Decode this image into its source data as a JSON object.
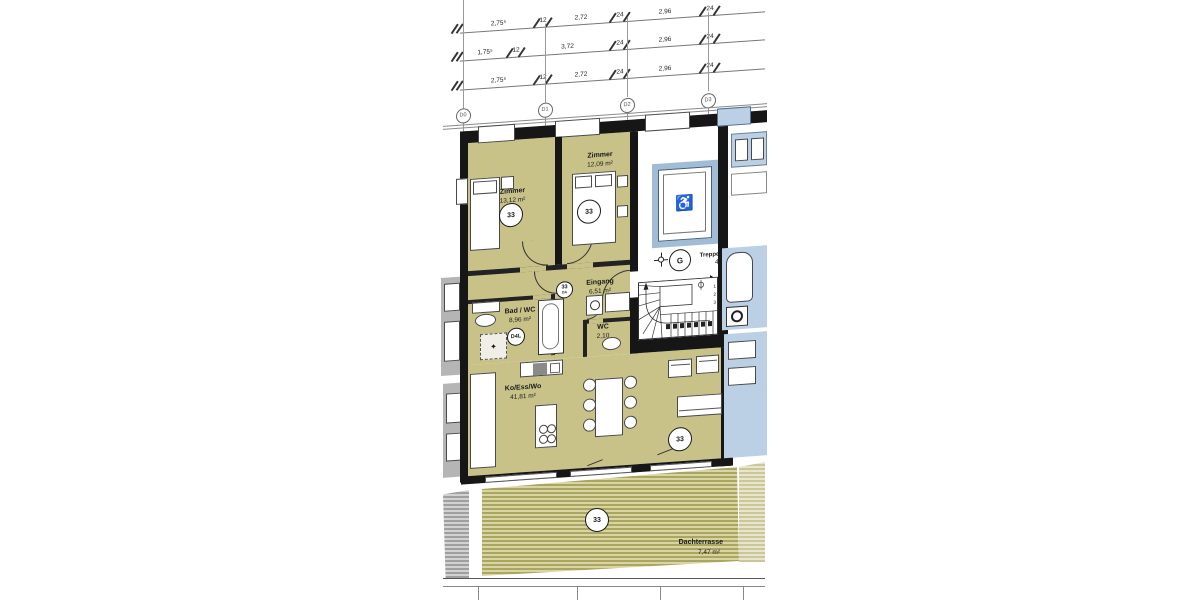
{
  "plan": {
    "rooms": [
      {
        "name": "Zimmer",
        "area": "13,12 m²"
      },
      {
        "name": "Zimmer",
        "area": "12,09 m²"
      },
      {
        "name": "Eingang",
        "area": "6,51 m²"
      },
      {
        "name": "Bad / WC",
        "area": "8,96 m²"
      },
      {
        "name": "WC",
        "area": "2,10"
      },
      {
        "name": "Ko/Ess/Wo",
        "area": "41,81 m²"
      },
      {
        "name": "Treppenhaus",
        "area": "4,95 m²"
      },
      {
        "name": "Dachterrasse",
        "area": "7,47 m²"
      }
    ],
    "markers": {
      "unit": "33",
      "unit_sub": "DA",
      "door": "D4L",
      "point": "G"
    },
    "grid": [
      "D0",
      "D1",
      "D2",
      "D3"
    ],
    "dims": {
      "rows": [
        {
          "segs": [
            "2,75⁵",
            "12",
            "2,72",
            "24",
            "2,96",
            "24"
          ]
        },
        {
          "segs": [
            "1,75⁵",
            "12",
            "3,72",
            "24",
            "2,96",
            "24"
          ]
        },
        {
          "segs": [
            "2,75⁵",
            "12",
            "2,72",
            "24",
            "2,96",
            "24"
          ]
        }
      ]
    },
    "stairs": {
      "numbers": [
        "1",
        "2",
        "3"
      ]
    },
    "icons": {
      "wheelchair": "♿"
    },
    "colors": {
      "room_fill": "#c8c289",
      "wall": "#161616",
      "glass": "#bcd0e5",
      "terrace_stripe": "#aaa55f"
    }
  }
}
